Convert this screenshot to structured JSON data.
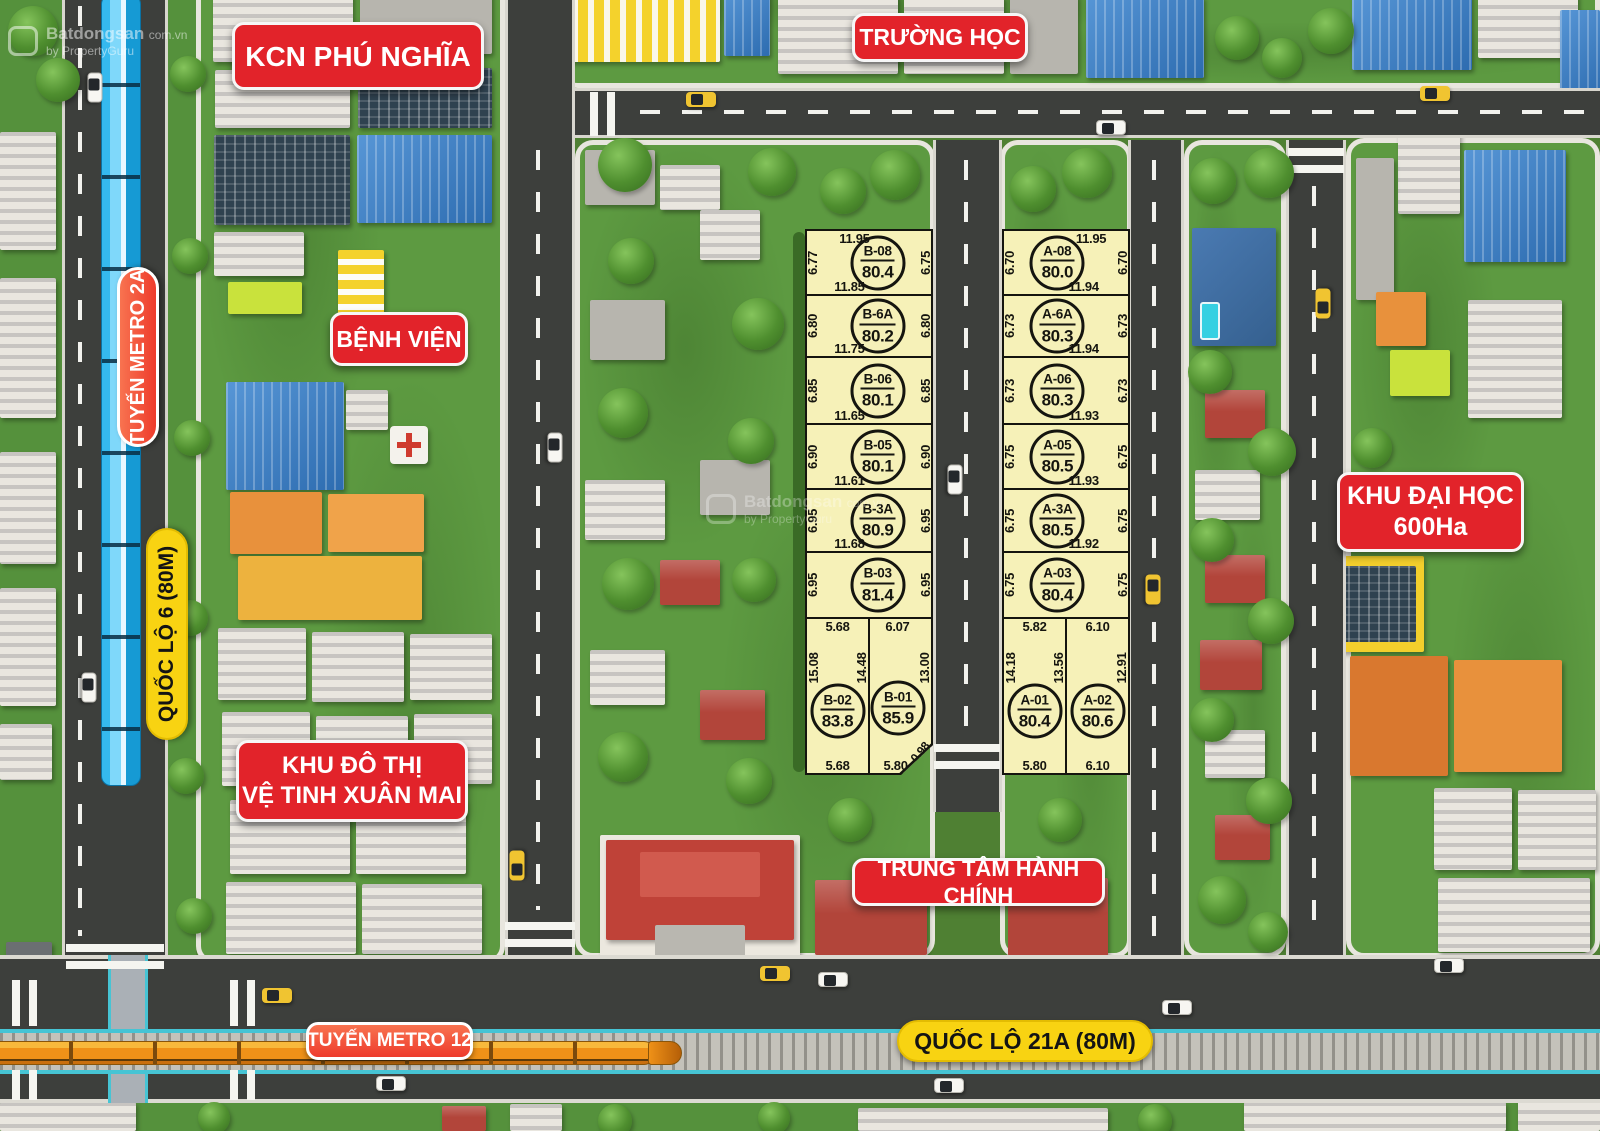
{
  "watermark": {
    "brand": "Batdongsan",
    "domain": "com.vn",
    "byline": "by PropertyGuru"
  },
  "labels": {
    "kcn": "KCN PHÚ NGHĨA",
    "benh_vien": "BỆNH VIỆN",
    "truong_hoc": "TRƯỜNG HỌC",
    "khu_do_thi_line1": "KHU ĐÔ THỊ",
    "khu_do_thi_line2": "VỆ TINH XUÂN MAI",
    "trung_tam": "TRUNG TÂM HÀNH CHÍNH",
    "khu_dai_hoc_line1": "KHU ĐẠI HỌC",
    "khu_dai_hoc_line2": "600Ha",
    "metro_2a": "TUYẾN METRO 2A",
    "quoc_lo_6": "QUỐC LỘ 6 (80M)",
    "metro_12": "TUYẾN METRO 12",
    "quoc_lo_21a": "QUỐC LỘ 21A (80M)"
  },
  "plots": {
    "b": [
      {
        "code": "B-08",
        "area": "80.4",
        "top": "11.95",
        "left": "6.77",
        "right": "6.75",
        "bottom": "11.85"
      },
      {
        "code": "B-6A",
        "area": "80.2",
        "left": "6.80",
        "right": "6.80",
        "bottom": "11.75"
      },
      {
        "code": "B-06",
        "area": "80.1",
        "left": "6.85",
        "right": "6.85",
        "bottom": "11.65"
      },
      {
        "code": "B-05",
        "area": "80.1",
        "left": "6.90",
        "right": "6.90",
        "bottom": "11.61"
      },
      {
        "code": "B-3A",
        "area": "80.9",
        "left": "6.95",
        "right": "6.95",
        "bottom": "11.68"
      },
      {
        "code": "B-03",
        "area": "81.4",
        "left": "6.95",
        "right": "6.95"
      },
      {
        "code": "B-02",
        "area": "83.8",
        "top": "5.68",
        "left": "15.08",
        "right": "14.48",
        "bottom": "5.68"
      },
      {
        "code": "B-01",
        "area": "85.9",
        "top": "6.07",
        "right": "13.00",
        "bottom": "5.80",
        "corner": "0.98"
      }
    ],
    "a": [
      {
        "code": "A-08",
        "area": "80.0",
        "top": "11.95",
        "left": "6.70",
        "right": "6.70",
        "bottom": "11.94"
      },
      {
        "code": "A-6A",
        "area": "80.3",
        "left": "6.73",
        "right": "6.73",
        "bottom": "11.94"
      },
      {
        "code": "A-06",
        "area": "80.3",
        "left": "6.73",
        "right": "6.73",
        "bottom": "11.93"
      },
      {
        "code": "A-05",
        "area": "80.5",
        "left": "6.75",
        "right": "6.75",
        "bottom": "11.93"
      },
      {
        "code": "A-3A",
        "area": "80.5",
        "left": "6.75",
        "right": "6.75",
        "bottom": "11.92"
      },
      {
        "code": "A-03",
        "area": "80.4",
        "left": "6.75",
        "right": "6.75"
      },
      {
        "code": "A-01",
        "area": "80.4",
        "top": "5.82",
        "left": "14.18",
        "right": "13.56",
        "bottom": "5.80"
      },
      {
        "code": "A-02",
        "area": "80.6",
        "top": "6.10",
        "right": "12.91",
        "bottom": "6.10"
      }
    ]
  }
}
